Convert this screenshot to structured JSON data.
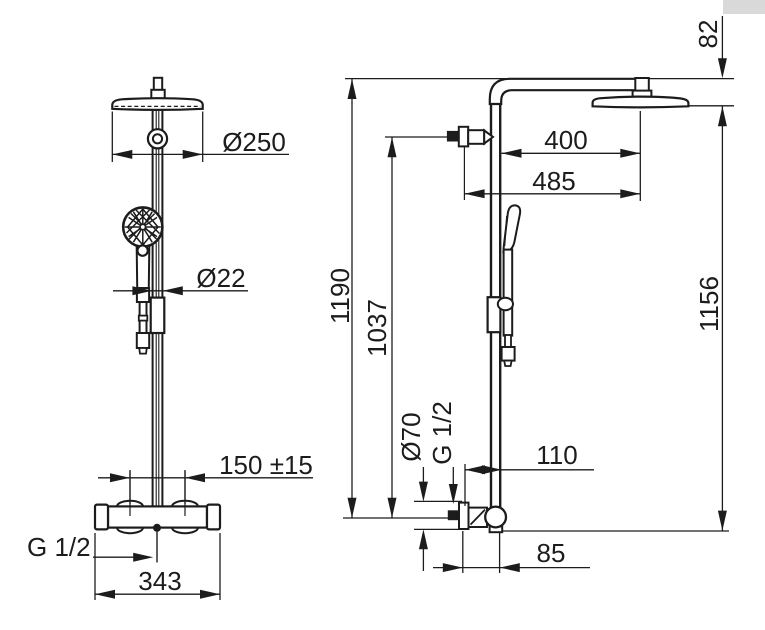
{
  "drawing": {
    "kind": "technical-dimension-drawing",
    "subject": "shower column with overhead shower and hand shower, front and side views",
    "views": [
      "front",
      "side"
    ]
  },
  "colors": {
    "line": "#1c1c1c",
    "background": "#ffffff",
    "corner_patch": "#d9d9d9"
  },
  "labels": {
    "front": {
      "head_diameter": "Ø250",
      "rail_diameter": "Ø22",
      "inlet_spacing": "150 ±15",
      "bottom_thread": "G 1/2",
      "body_width": "343"
    },
    "side": {
      "head_drop": "82",
      "rail_to_head": "400",
      "wall_to_head": "485",
      "height_total": "1190",
      "height_wall_inlet": "1037",
      "height_head_plane": "1156",
      "flange_diameter": "Ø70",
      "wall_thread": "G 1/2",
      "wall_to_rail": "110",
      "wall_to_outlet": "85"
    }
  }
}
